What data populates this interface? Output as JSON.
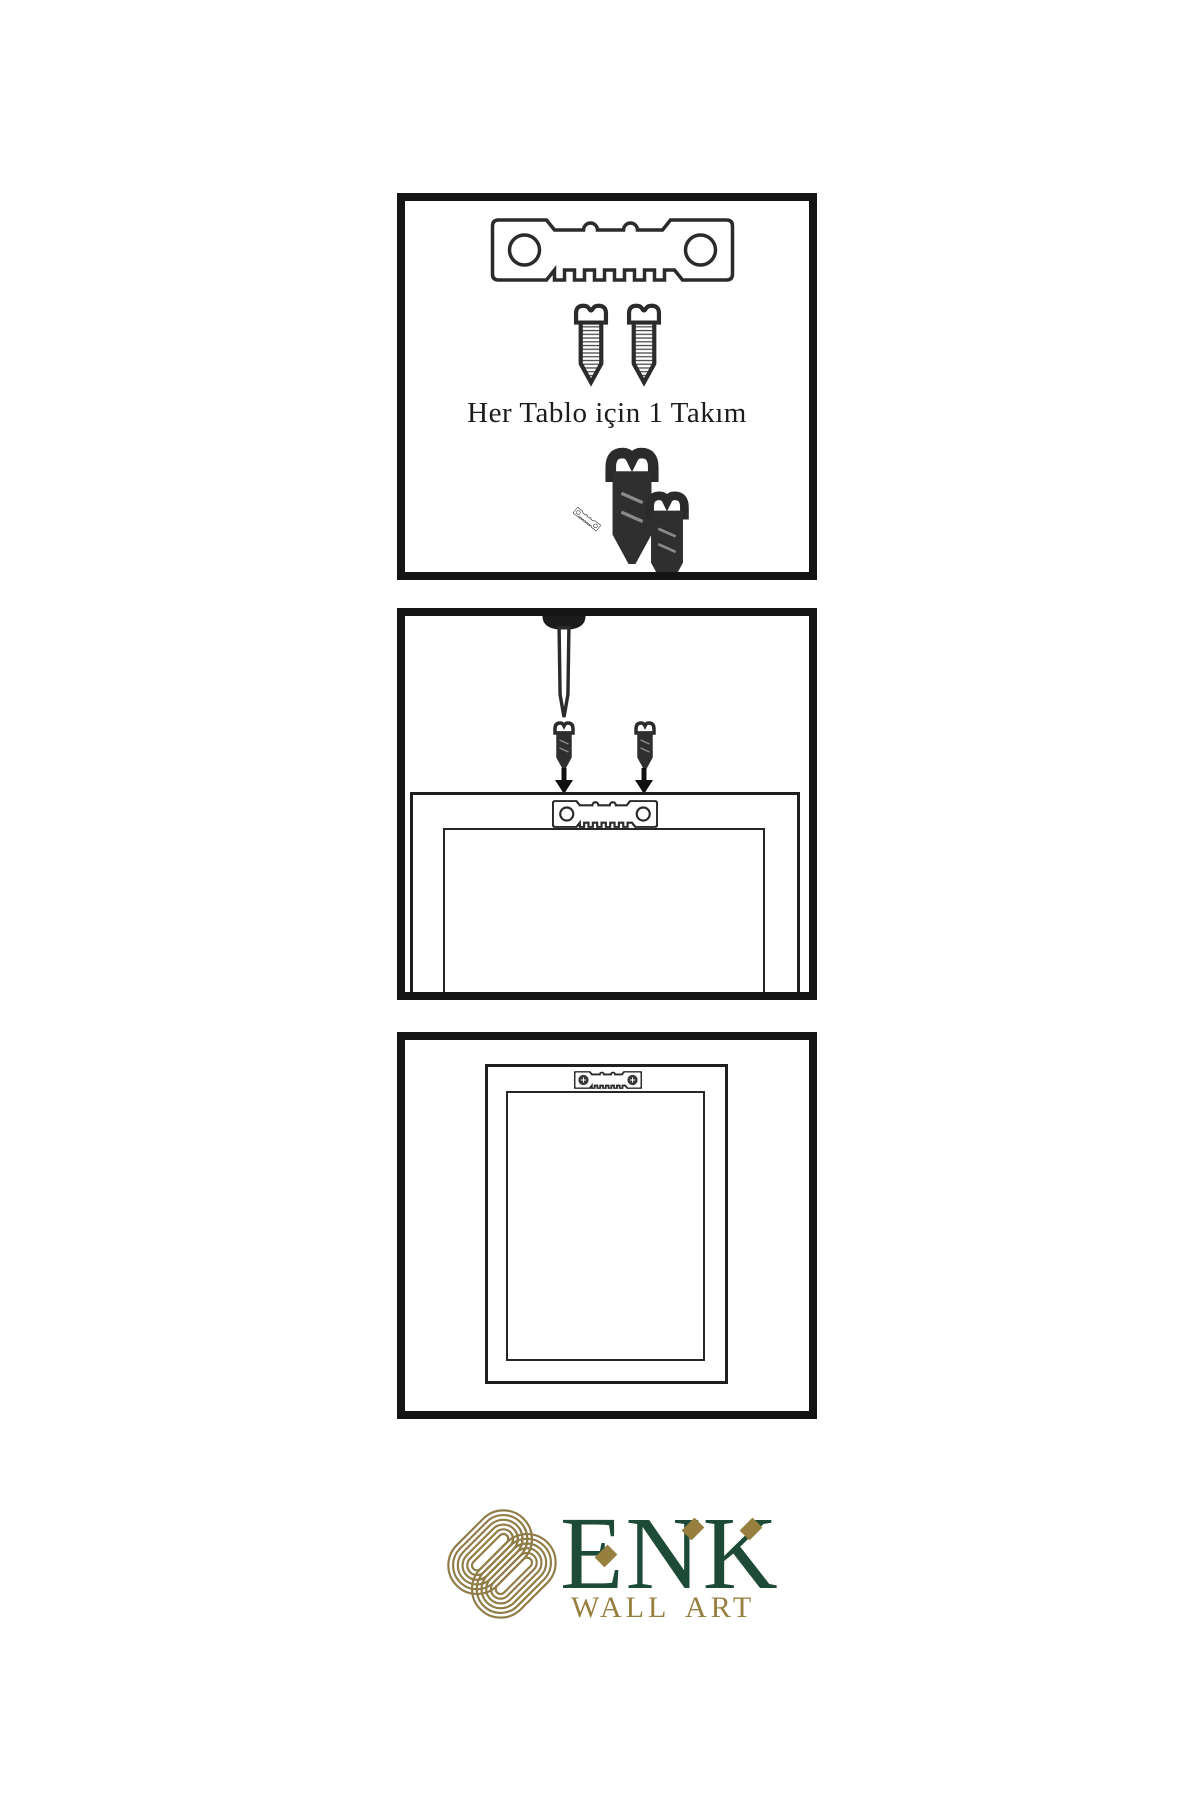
{
  "panels": {
    "step1": {
      "caption": "Her Tablo için 1 Takım",
      "parts": [
        "sawtooth-hanger",
        "screw",
        "screw",
        "screw-into-hanger-assembly"
      ]
    },
    "step2": {
      "parts": [
        "wall-nail",
        "screw",
        "screw",
        "down-arrow",
        "down-arrow",
        "frame-back-with-hanger"
      ]
    },
    "step3": {
      "parts": [
        "hung-frame-with-mounted-hanger"
      ]
    }
  },
  "logo": {
    "wordmark": "ENK",
    "tagline": "WALL ART"
  },
  "colors": {
    "background": "#ffffff",
    "panel_border": "#141414",
    "line_art": "#2b2b2b",
    "brand_green": "#1e4b38",
    "brand_gold": "#97803f"
  }
}
